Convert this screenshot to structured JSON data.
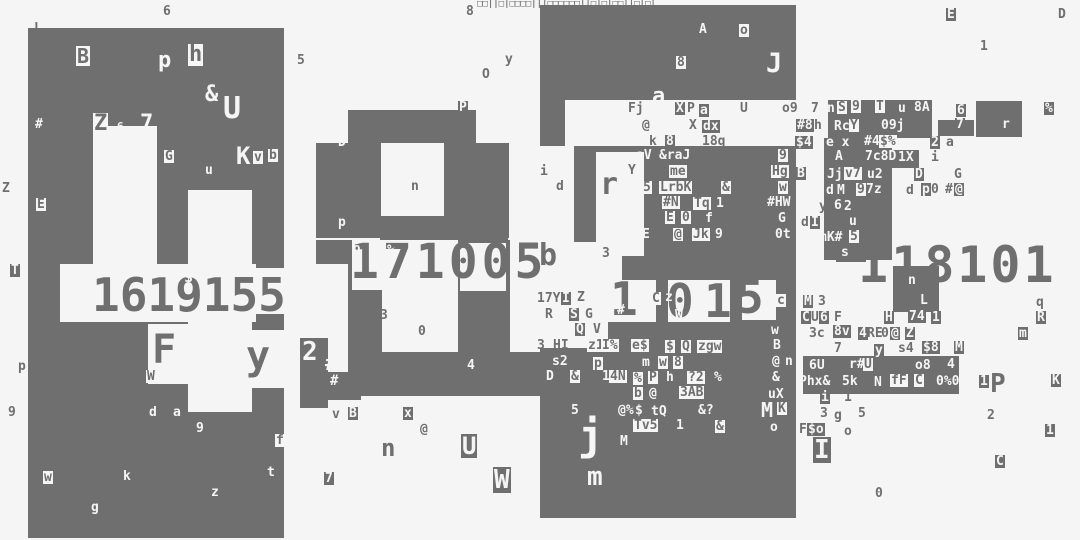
{
  "canvas": {
    "width": 1080,
    "height": 540,
    "bg": "#f5f5f5",
    "fg": "#6f6f6f",
    "panel_color": "#6f6f6f",
    "hole_color": "#f5f5f5"
  },
  "big_digit_rows": [
    {
      "t": "1619155",
      "x": 92,
      "y": 272,
      "s": 46,
      "ls": 0,
      "c": "d"
    },
    {
      "t": "$",
      "x": 184,
      "y": 270,
      "s": 15,
      "ls": 0,
      "c": "w"
    },
    {
      "t": "171005",
      "x": 350,
      "y": 238,
      "s": 48,
      "ls": 4,
      "c": "d"
    },
    {
      "t": "1",
      "x": 610,
      "y": 276,
      "s": 46,
      "ls": 0,
      "c": "d"
    },
    {
      "t": "0",
      "x": 666,
      "y": 278,
      "s": 46,
      "ls": 0,
      "c": "d"
    },
    {
      "t": "1",
      "x": 704,
      "y": 278,
      "s": 46,
      "ls": 0,
      "c": "d"
    },
    {
      "t": "5",
      "x": 736,
      "y": 274,
      "s": 46,
      "ls": 0,
      "c": "d"
    },
    {
      "t": ":",
      "x": 782,
      "y": 284,
      "s": 28,
      "ls": 0,
      "c": "d"
    },
    {
      "t": "118101",
      "x": 858,
      "y": 240,
      "s": 50,
      "ls": 3,
      "c": "d"
    }
  ],
  "blocks": [
    [
      28,
      28,
      256,
      510
    ],
    [
      348,
      110,
      128,
      33
    ],
    [
      316,
      143,
      65,
      95
    ],
    [
      444,
      143,
      65,
      95
    ],
    [
      380,
      216,
      128,
      24
    ],
    [
      316,
      240,
      44,
      24
    ],
    [
      348,
      240,
      34,
      112
    ],
    [
      458,
      240,
      52,
      112
    ],
    [
      348,
      352,
      212,
      44
    ],
    [
      300,
      338,
      28,
      70
    ],
    [
      325,
      372,
      36,
      28
    ],
    [
      540,
      5,
      256,
      513
    ],
    [
      828,
      100,
      104,
      38
    ],
    [
      976,
      101,
      46,
      36
    ],
    [
      938,
      120,
      36,
      16
    ],
    [
      824,
      138,
      68,
      122
    ],
    [
      891,
      150,
      28,
      18
    ],
    [
      893,
      266,
      46,
      46
    ],
    [
      836,
      246,
      30,
      16
    ],
    [
      803,
      356,
      156,
      38
    ]
  ],
  "holes": [
    [
      93,
      126,
      64,
      140
    ],
    [
      188,
      190,
      64,
      76
    ],
    [
      60,
      264,
      196,
      58
    ],
    [
      256,
      268,
      28,
      46
    ],
    [
      148,
      324,
      44,
      60
    ],
    [
      188,
      322,
      64,
      90
    ],
    [
      244,
      330,
      40,
      58
    ],
    [
      352,
      240,
      30,
      50
    ],
    [
      460,
      243,
      46,
      48
    ],
    [
      565,
      100,
      231,
      46
    ],
    [
      540,
      146,
      34,
      112
    ],
    [
      596,
      152,
      48,
      104
    ],
    [
      540,
      242,
      82,
      54
    ],
    [
      540,
      290,
      68,
      58
    ],
    [
      606,
      280,
      50,
      42
    ],
    [
      668,
      280,
      62,
      42
    ],
    [
      742,
      280,
      34,
      40
    ]
  ],
  "glyphs": [
    [
      "6",
      163,
      5,
      "d"
    ],
    [
      "L",
      34,
      22,
      "d"
    ],
    [
      "8",
      466,
      5,
      "d"
    ],
    [
      "□□||□|□□□□|||□□□□□□||□|□|□□||□|□|",
      477,
      0,
      "d",
      9
    ],
    [
      "E",
      946,
      8,
      "db"
    ],
    [
      "D",
      1058,
      8,
      "d"
    ],
    [
      "1",
      980,
      40,
      "d"
    ],
    [
      "Z",
      2,
      182,
      "d"
    ],
    [
      "T",
      10,
      264,
      "db"
    ],
    [
      "p",
      18,
      360,
      "d"
    ],
    [
      "9",
      8,
      406,
      "d"
    ],
    [
      "5",
      297,
      54,
      "d"
    ],
    [
      "y",
      505,
      53,
      "d"
    ],
    [
      "O",
      482,
      68,
      "d"
    ],
    [
      "P",
      458,
      101,
      "db"
    ],
    [
      "B",
      76,
      46,
      "wb",
      20
    ],
    [
      "p",
      158,
      50,
      "w",
      22
    ],
    [
      "h",
      188,
      44,
      "wb",
      22
    ],
    [
      "&",
      205,
      84,
      "w",
      22
    ],
    [
      "U",
      223,
      94,
      "w",
      30
    ],
    [
      "#",
      35,
      118,
      "w"
    ],
    [
      "Z",
      93,
      113,
      "wb",
      22
    ],
    [
      "6",
      117,
      121,
      "w",
      11
    ],
    [
      "7",
      140,
      113,
      "w",
      22
    ],
    [
      "G",
      164,
      150,
      "wb"
    ],
    [
      "K",
      236,
      144,
      "w",
      24
    ],
    [
      "v",
      253,
      151,
      "wb"
    ],
    [
      "b",
      268,
      149,
      "wb"
    ],
    [
      "u",
      205,
      164,
      "w"
    ],
    [
      "E",
      36,
      198,
      "wb"
    ],
    [
      "F",
      152,
      330,
      "d",
      40
    ],
    [
      "y",
      246,
      336,
      "d",
      40
    ],
    [
      "W",
      146,
      370,
      "wb"
    ],
    [
      "d",
      149,
      406,
      "w"
    ],
    [
      "a",
      173,
      406,
      "w"
    ],
    [
      "9",
      196,
      422,
      "w"
    ],
    [
      "f",
      275,
      434,
      "wb"
    ],
    [
      "t",
      267,
      466,
      "w"
    ],
    [
      "k",
      123,
      470,
      "w"
    ],
    [
      "z",
      211,
      486,
      "w"
    ],
    [
      "g",
      91,
      501,
      "w"
    ],
    [
      "w",
      43,
      471,
      "wb"
    ],
    [
      "D",
      338,
      136,
      "w"
    ],
    [
      "n",
      411,
      180,
      "d"
    ],
    [
      "p",
      338,
      216,
      "w"
    ],
    [
      "9",
      353,
      245,
      "w"
    ],
    [
      "%",
      387,
      244,
      "w"
    ],
    [
      "3",
      380,
      309,
      "d"
    ],
    [
      "0",
      418,
      325,
      "d"
    ],
    [
      "4",
      467,
      359,
      "w"
    ],
    [
      "2",
      301,
      339,
      "db",
      26
    ],
    [
      "#",
      325,
      353,
      "w",
      20
    ],
    [
      "#",
      330,
      374,
      "w",
      14
    ],
    [
      "v",
      332,
      408,
      "d"
    ],
    [
      "B",
      348,
      407,
      "db"
    ],
    [
      "x",
      403,
      407,
      "db"
    ],
    [
      "@",
      420,
      423,
      "d"
    ],
    [
      "n",
      381,
      436,
      "d",
      24
    ],
    [
      "U",
      461,
      434,
      "db",
      24
    ],
    [
      "7",
      324,
      472,
      "db"
    ],
    [
      "W",
      493,
      467,
      "db",
      26
    ],
    [
      "A",
      699,
      23,
      "w"
    ],
    [
      "o",
      739,
      24,
      "wb"
    ],
    [
      "8",
      676,
      56,
      "wb"
    ],
    [
      "J",
      766,
      50,
      "w",
      27
    ],
    [
      "a",
      652,
      86,
      "w",
      22
    ],
    [
      "Fj",
      627,
      102,
      "wb"
    ],
    [
      "X",
      675,
      102,
      "db"
    ],
    [
      "P",
      687,
      102,
      "d"
    ],
    [
      "a",
      699,
      104,
      "db"
    ],
    [
      "U",
      740,
      102,
      "d"
    ],
    [
      "o9",
      782,
      102,
      "d"
    ],
    [
      "@",
      642,
      119,
      "d"
    ],
    [
      "X",
      689,
      119,
      "d"
    ],
    [
      "dx",
      702,
      120,
      "db"
    ],
    [
      "k",
      649,
      135,
      "d"
    ],
    [
      "8",
      665,
      135,
      "db"
    ],
    [
      "18q",
      702,
      135,
      "d"
    ],
    [
      "i",
      540,
      165,
      "d"
    ],
    [
      "d",
      555,
      180,
      "wb"
    ],
    [
      "r",
      600,
      170,
      "d",
      30
    ],
    [
      "b",
      539,
      241,
      "d",
      30
    ],
    [
      "3",
      601,
      247,
      "wb"
    ],
    [
      "aV",
      636,
      149,
      "w"
    ],
    [
      "&raJ",
      659,
      149,
      "w"
    ],
    [
      "Y",
      627,
      164,
      "wb"
    ],
    [
      "me",
      669,
      165,
      "wb"
    ],
    [
      "5",
      642,
      181,
      "wb"
    ],
    [
      "LrbK",
      659,
      181,
      "wb"
    ],
    [
      "&",
      721,
      181,
      "wb"
    ],
    [
      "6",
      634,
      196,
      "w"
    ],
    [
      "#N",
      662,
      196,
      "wb"
    ],
    [
      "Tq",
      693,
      197,
      "wb"
    ],
    [
      "1",
      716,
      197,
      "w"
    ],
    [
      "E",
      665,
      211,
      "wb"
    ],
    [
      "0",
      681,
      211,
      "wb"
    ],
    [
      "f",
      705,
      212,
      "w"
    ],
    [
      "E",
      642,
      228,
      "w"
    ],
    [
      "@",
      673,
      228,
      "wb"
    ],
    [
      "Jk",
      692,
      228,
      "wb"
    ],
    [
      "9",
      715,
      228,
      "w"
    ],
    [
      "9",
      778,
      149,
      "wb"
    ],
    [
      "Hg",
      771,
      165,
      "wb"
    ],
    [
      "w",
      778,
      181,
      "wb"
    ],
    [
      "#HW",
      767,
      196,
      "w"
    ],
    [
      "G",
      778,
      212,
      "w"
    ],
    [
      "0t",
      775,
      228,
      "w"
    ],
    [
      "C",
      651,
      292,
      "wb"
    ],
    [
      "z",
      665,
      291,
      "w"
    ],
    [
      "#",
      617,
      304,
      "w"
    ],
    [
      "W",
      675,
      309,
      "w"
    ],
    [
      "c",
      776,
      294,
      "wb"
    ],
    [
      "17Y",
      537,
      292,
      "d"
    ],
    [
      "I",
      561,
      292,
      "db"
    ],
    [
      "Z",
      577,
      291,
      "d"
    ],
    [
      "R",
      545,
      308,
      "d"
    ],
    [
      "S",
      569,
      308,
      "db"
    ],
    [
      "G",
      585,
      308,
      "d"
    ],
    [
      "Q",
      575,
      323,
      "db"
    ],
    [
      "V",
      593,
      323,
      "d"
    ],
    [
      "3",
      537,
      339,
      "d"
    ],
    [
      "HI",
      553,
      339,
      "d"
    ],
    [
      "z1",
      587,
      339,
      "wb"
    ],
    [
      "I%",
      601,
      339,
      "wb"
    ],
    [
      "e$",
      631,
      339,
      "wb"
    ],
    [
      "$",
      665,
      340,
      "wb"
    ],
    [
      "Q",
      681,
      340,
      "wb"
    ],
    [
      "zgw",
      697,
      340,
      "wb"
    ],
    [
      "Ts",
      535,
      355,
      "d"
    ],
    [
      "s2",
      551,
      355,
      "db"
    ],
    [
      "p",
      593,
      357,
      "wb"
    ],
    [
      "m",
      641,
      356,
      "db"
    ],
    [
      "w",
      658,
      356,
      "wb"
    ],
    [
      "8",
      673,
      356,
      "wb"
    ],
    [
      "D",
      545,
      370,
      "db"
    ],
    [
      "&",
      570,
      370,
      "wb"
    ],
    [
      "1",
      601,
      370,
      "db"
    ],
    [
      "4N",
      609,
      370,
      "wb"
    ],
    [
      "%",
      633,
      372,
      "wb"
    ],
    [
      "P",
      648,
      371,
      "wb"
    ],
    [
      "h",
      665,
      371,
      "db"
    ],
    [
      "?2",
      687,
      371,
      "wb"
    ],
    [
      "%",
      713,
      371,
      "db"
    ],
    [
      "b",
      633,
      387,
      "wb"
    ],
    [
      "@",
      648,
      387,
      "db"
    ],
    [
      "3AB",
      679,
      386,
      "wb"
    ],
    [
      "5",
      570,
      404,
      "db"
    ],
    [
      "@%",
      617,
      404,
      "db"
    ],
    [
      "$",
      635,
      404,
      "w"
    ],
    [
      "tQ",
      650,
      405,
      "db"
    ],
    [
      "&?",
      697,
      404,
      "db"
    ],
    [
      "Tv5",
      633,
      419,
      "wb"
    ],
    [
      "1",
      675,
      419,
      "db"
    ],
    [
      "&",
      715,
      420,
      "wb"
    ],
    [
      "M",
      619,
      435,
      "db"
    ],
    [
      "j",
      578,
      415,
      "w",
      42
    ],
    [
      "m",
      587,
      464,
      "w",
      26
    ],
    [
      "w",
      771,
      324,
      "w"
    ],
    [
      "B",
      773,
      339,
      "w"
    ],
    [
      "@",
      771,
      355,
      "db"
    ],
    [
      "n",
      785,
      355,
      "w"
    ],
    [
      "&",
      771,
      371,
      "db"
    ],
    [
      "uX",
      768,
      388,
      "w"
    ],
    [
      "M",
      760,
      400,
      "db",
      20
    ],
    [
      "K",
      777,
      402,
      "wb"
    ],
    [
      "o",
      770,
      421,
      "w"
    ],
    [
      "7",
      811,
      102,
      "d"
    ],
    [
      "n",
      827,
      102,
      "w"
    ],
    [
      "S",
      837,
      101,
      "wb"
    ],
    [
      "9",
      851,
      100,
      "wb"
    ],
    [
      "T",
      875,
      100,
      "wb"
    ],
    [
      "u",
      898,
      102,
      "w"
    ],
    [
      "8A",
      914,
      101,
      "w"
    ],
    [
      "6",
      956,
      104,
      "db"
    ],
    [
      "%",
      1044,
      102,
      "db"
    ],
    [
      "#8",
      796,
      119,
      "db"
    ],
    [
      "h",
      814,
      119,
      "d"
    ],
    [
      "Rc",
      834,
      120,
      "w"
    ],
    [
      "Y",
      849,
      119,
      "wb"
    ],
    [
      "09j",
      881,
      119,
      "w"
    ],
    [
      "7",
      955,
      118,
      "db"
    ],
    [
      "r",
      1002,
      118,
      "w"
    ],
    [
      "$4",
      795,
      136,
      "db"
    ],
    [
      "e x",
      826,
      136,
      "w"
    ],
    [
      "#4",
      864,
      135,
      "w"
    ],
    [
      "$%",
      879,
      135,
      "wb"
    ],
    [
      "2",
      930,
      136,
      "db"
    ],
    [
      "a",
      946,
      136,
      "d"
    ],
    [
      "A",
      835,
      150,
      "w"
    ],
    [
      "7c8D",
      865,
      150,
      "w"
    ],
    [
      "1X",
      897,
      151,
      "db"
    ],
    [
      "i",
      931,
      151,
      "d"
    ],
    [
      "B",
      796,
      167,
      "db"
    ],
    [
      "Jj",
      827,
      168,
      "w"
    ],
    [
      "v7",
      844,
      167,
      "wb"
    ],
    [
      "u2",
      867,
      168,
      "w"
    ],
    [
      "D",
      914,
      168,
      "db"
    ],
    [
      "G",
      954,
      168,
      "d"
    ],
    [
      "d",
      826,
      184,
      "w"
    ],
    [
      "M",
      836,
      184,
      "db"
    ],
    [
      "9",
      856,
      183,
      "wb"
    ],
    [
      "7z",
      866,
      183,
      "w"
    ],
    [
      "d",
      906,
      184,
      "d"
    ],
    [
      "p",
      921,
      183,
      "db"
    ],
    [
      "0",
      931,
      183,
      "d"
    ],
    [
      "#",
      945,
      183,
      "d"
    ],
    [
      "@",
      954,
      183,
      "db"
    ],
    [
      "y",
      819,
      200,
      "d"
    ],
    [
      "6",
      833,
      199,
      "db"
    ],
    [
      "2",
      844,
      200,
      "w"
    ],
    [
      "d",
      801,
      216,
      "d"
    ],
    [
      "I",
      810,
      216,
      "db"
    ],
    [
      "u",
      849,
      215,
      "w"
    ],
    [
      "mK#",
      819,
      231,
      "w"
    ],
    [
      "5",
      849,
      230,
      "wb"
    ],
    [
      "s",
      841,
      246,
      "w"
    ],
    [
      "n",
      908,
      274,
      "w"
    ],
    [
      "L",
      920,
      294,
      "w"
    ],
    [
      "M",
      803,
      295,
      "db"
    ],
    [
      "3",
      818,
      295,
      "d"
    ],
    [
      "q",
      1036,
      296,
      "d"
    ],
    [
      "C",
      801,
      311,
      "db"
    ],
    [
      "U",
      811,
      311,
      "d"
    ],
    [
      "6",
      819,
      311,
      "db"
    ],
    [
      "F",
      834,
      311,
      "d"
    ],
    [
      "H",
      884,
      311,
      "db"
    ],
    [
      "74",
      908,
      310,
      "db"
    ],
    [
      "1",
      931,
      311,
      "db"
    ],
    [
      "R",
      1036,
      311,
      "db"
    ],
    [
      "3c",
      809,
      327,
      "d"
    ],
    [
      "8v",
      833,
      325,
      "db"
    ],
    [
      "4",
      858,
      327,
      "db"
    ],
    [
      "RE",
      867,
      327,
      "d"
    ],
    [
      "0",
      881,
      327,
      "d"
    ],
    [
      "@",
      890,
      327,
      "db"
    ],
    [
      "Z",
      905,
      327,
      "db"
    ],
    [
      "m",
      1018,
      327,
      "db"
    ],
    [
      "7",
      834,
      342,
      "d"
    ],
    [
      "y",
      874,
      344,
      "db"
    ],
    [
      "s4",
      898,
      342,
      "d"
    ],
    [
      "$8",
      922,
      341,
      "db"
    ],
    [
      "M",
      954,
      341,
      "db"
    ],
    [
      "6U",
      809,
      359,
      "w"
    ],
    [
      "r#",
      849,
      358,
      "w"
    ],
    [
      "U",
      863,
      358,
      "wb"
    ],
    [
      "o8",
      915,
      359,
      "w"
    ],
    [
      "4",
      947,
      358,
      "w"
    ],
    [
      "Phx&",
      799,
      375,
      "w"
    ],
    [
      "5k",
      842,
      375,
      "w"
    ],
    [
      "N",
      874,
      376,
      "w"
    ],
    [
      "fF",
      890,
      374,
      "wb"
    ],
    [
      "C",
      914,
      374,
      "wb"
    ],
    [
      "0%0",
      936,
      375,
      "w"
    ],
    [
      "1",
      979,
      375,
      "db"
    ],
    [
      "P",
      990,
      371,
      "d",
      26
    ],
    [
      "K",
      1051,
      374,
      "db"
    ],
    [
      "i",
      820,
      391,
      "db"
    ],
    [
      "1",
      844,
      391,
      "d"
    ],
    [
      "3",
      820,
      407,
      "d"
    ],
    [
      "g",
      834,
      409,
      "d"
    ],
    [
      "5",
      858,
      407,
      "d"
    ],
    [
      "2",
      987,
      409,
      "d"
    ],
    [
      "F",
      799,
      423,
      "d"
    ],
    [
      "$o",
      807,
      423,
      "db"
    ],
    [
      "o",
      844,
      425,
      "d"
    ],
    [
      "1",
      1045,
      424,
      "db"
    ],
    [
      "I",
      813,
      437,
      "db",
      26
    ],
    [
      "C",
      995,
      455,
      "db"
    ],
    [
      "0",
      875,
      487,
      "d"
    ]
  ]
}
